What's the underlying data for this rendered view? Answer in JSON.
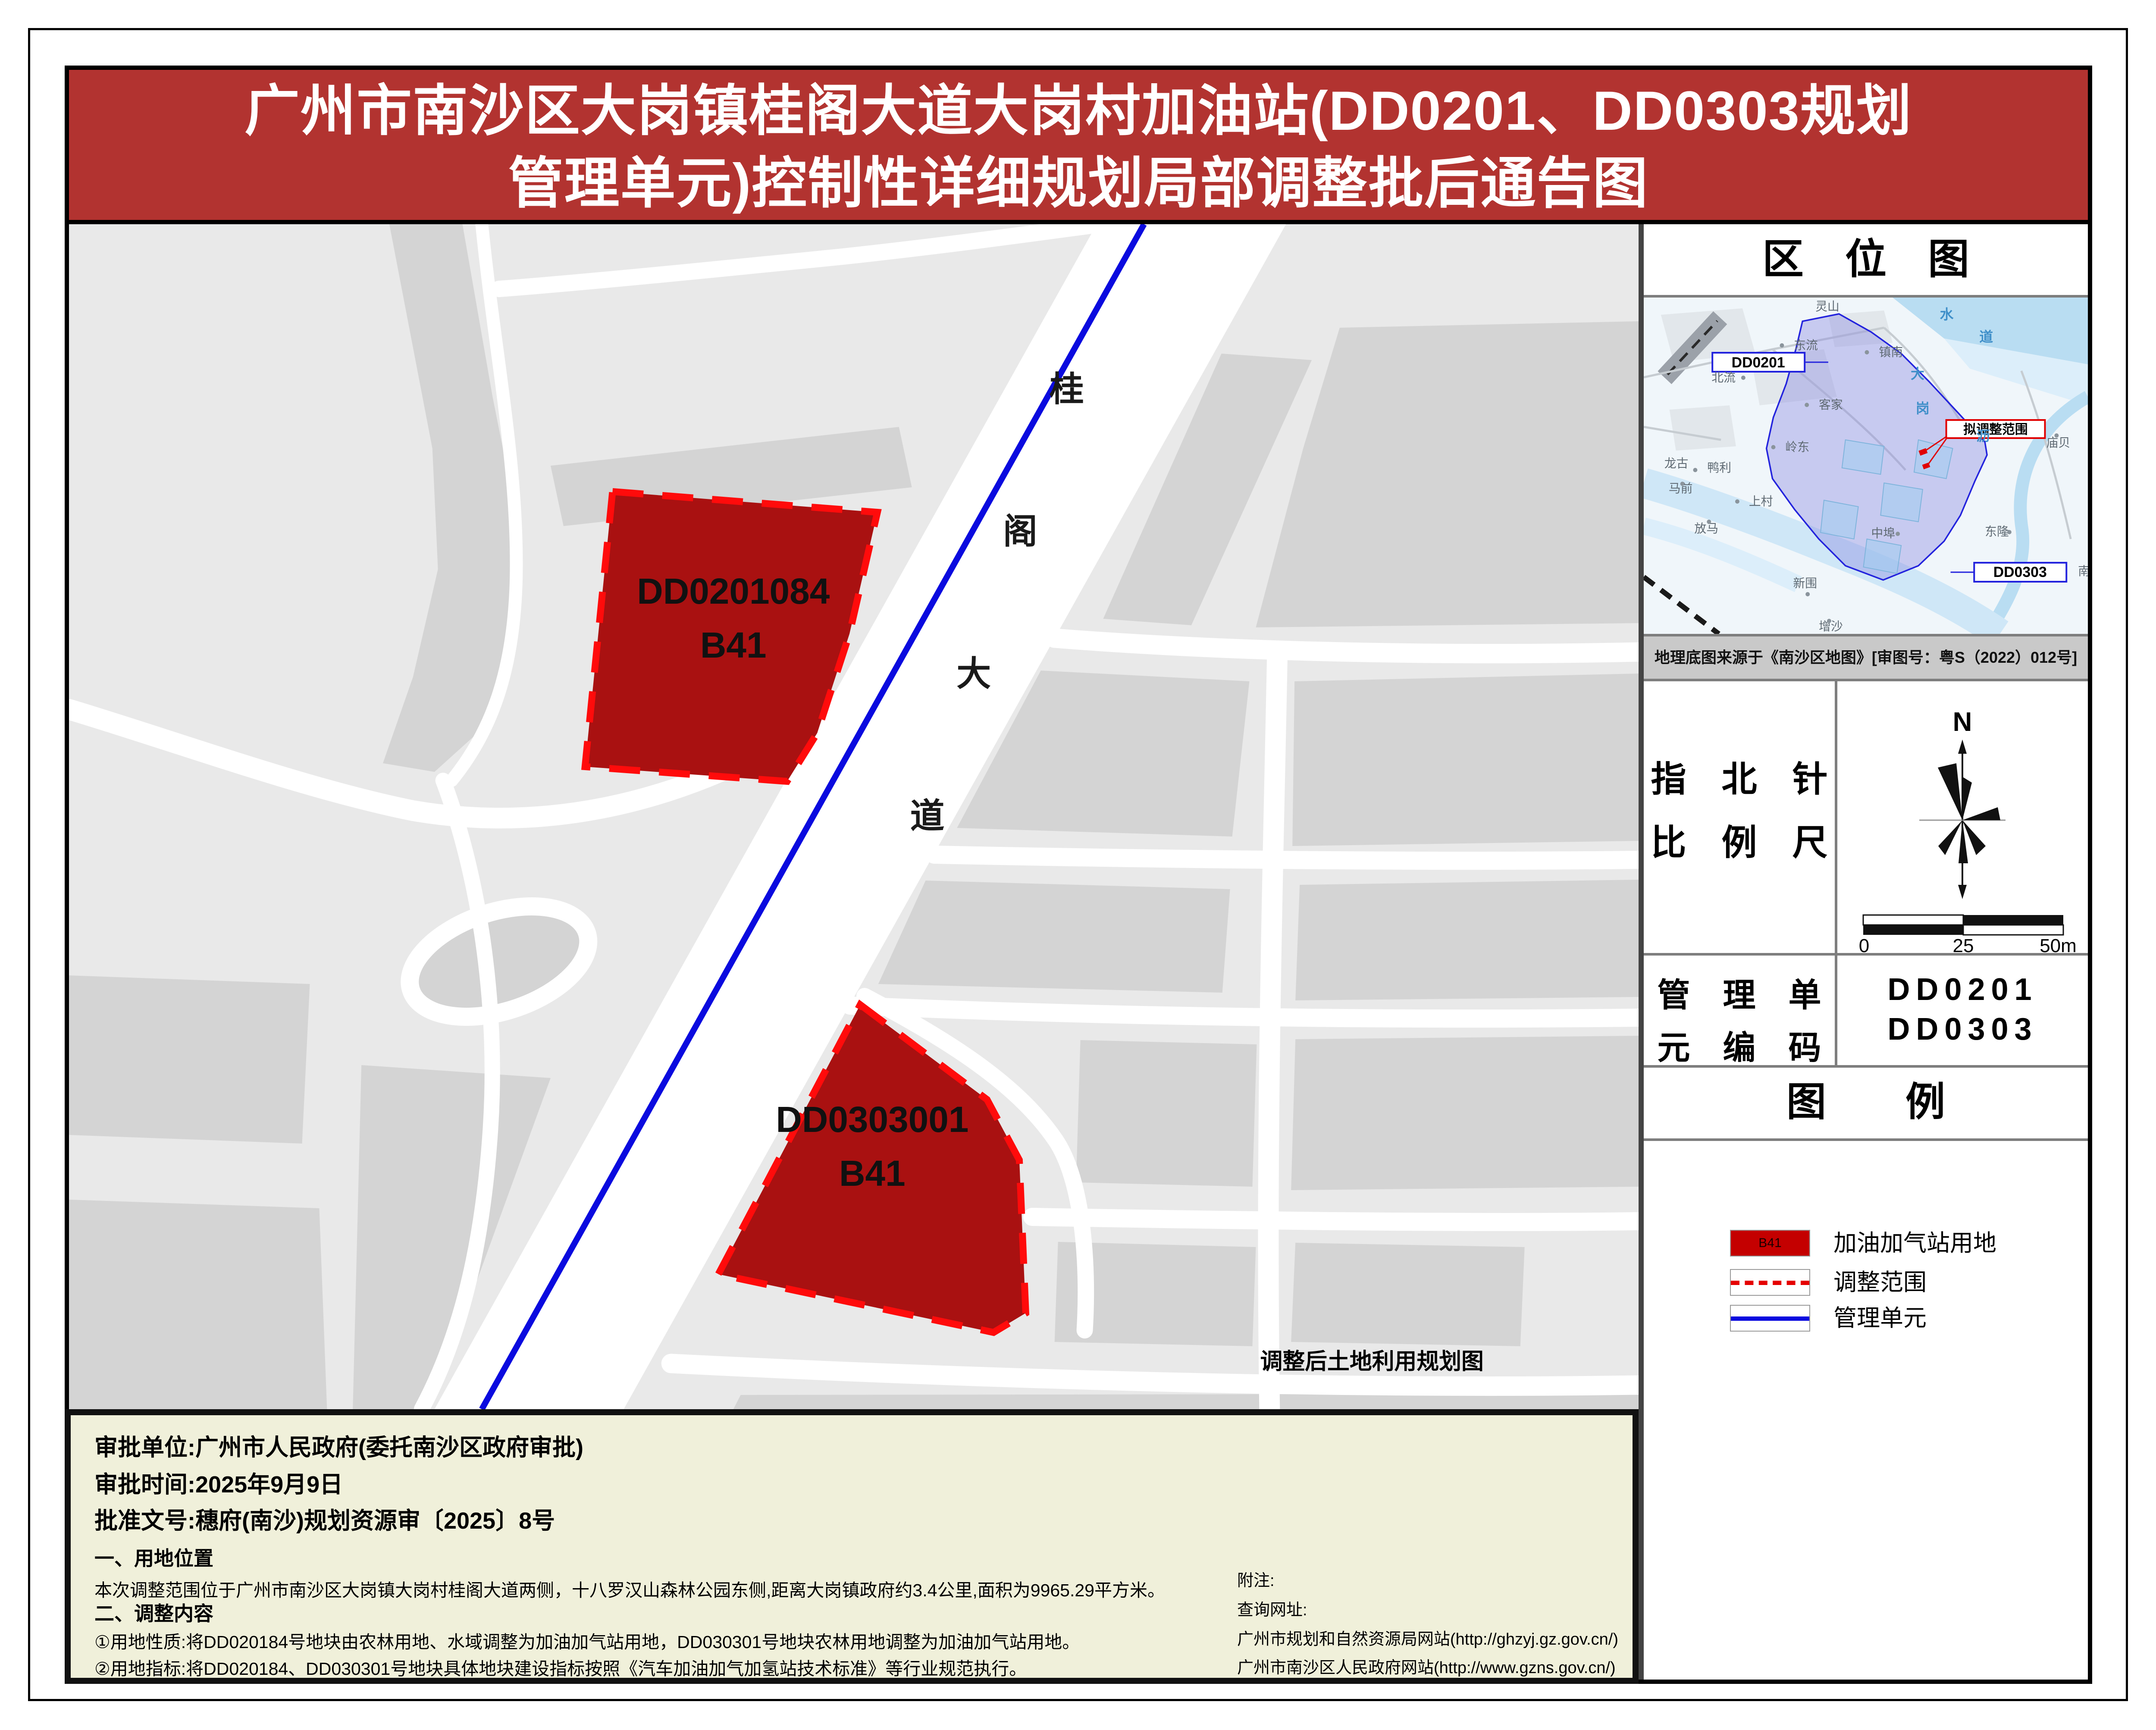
{
  "colors": {
    "title_red": "#b23330",
    "parcel_fill": "#a91111",
    "parcel_dash": "#ff0b0b",
    "legend_red": "#c40000",
    "unit_blue": "#0a0adf",
    "footer_yellow": "#f0f0da"
  },
  "title": {
    "line1": "广州市南沙区大岗镇桂阁大道大岗村加油站(DD0201、DD0303规划",
    "line2": "管理单元)控制性详细规划局部调整批后通告图"
  },
  "map": {
    "parcels": [
      {
        "code": "DD0201084",
        "use": "B41"
      },
      {
        "code": "DD0303001",
        "use": "B41"
      }
    ],
    "road_name": [
      "桂",
      "阁",
      "大",
      "道"
    ],
    "caption": "调整后土地利用规划图"
  },
  "sidebar": {
    "loc_title": "区　位　图",
    "locmap": {
      "boxes": {
        "dd0201": "DD0201",
        "dd0303": "DD0303",
        "adjust": "拟调整范围"
      },
      "places": [
        "灵山",
        "东流",
        "镇南",
        "北流",
        "客家",
        "岭东",
        "龙古",
        "鸭利",
        "马前",
        "上村",
        "放马",
        "中埠",
        "东隆",
        "新围",
        "增沙",
        "庙贝",
        "南"
      ],
      "water": [
        "水",
        "道",
        "大",
        "岗",
        "沥"
      ]
    },
    "source_note": "地理底图来源于《南沙区地图》[审图号：粤S（2022）012号]",
    "compass": {
      "label_line1": "指　北　针",
      "label_line2": "比　例　尺",
      "north": "N",
      "scale_ticks": [
        "0",
        "25",
        "50m"
      ]
    },
    "unit": {
      "label_line1": "管　理　单",
      "label_line2": "元　编　码",
      "codes": [
        "DD0201",
        "DD0303"
      ]
    },
    "legend": {
      "title": "图　　例",
      "items": [
        {
          "swatch_label": "B41",
          "label": "加油加气站用地"
        },
        {
          "label": "调整范围"
        },
        {
          "label": "管理单元"
        }
      ]
    }
  },
  "footer": {
    "approval_unit": "审批单位:广州市人民政府(委托南沙区政府审批)",
    "approval_date": "审批时间:2025年9月9日",
    "approval_doc": "批准文号:穗府(南沙)规划资源审〔2025〕8号",
    "sec1_title": "一、用地位置",
    "sec1_body": "本次调整范围位于广州市南沙区大岗镇大岗村桂阁大道两侧，十八罗汉山森林公园东侧,距离大岗镇政府约3.4公里,面积为9965.29平方米。",
    "sec2_title": "二、调整内容",
    "sec2_item1": "①用地性质:将DD020184号地块由农林用地、水域调整为加油加气站用地，DD030301号地块农林用地调整为加油加气站用地。",
    "sec2_item2": "②用地指标:将DD020184、DD030301号地块具体地块建设指标按照《汽车加油加气加氢站技术标准》等行业规范执行。",
    "notes_title": "附注:",
    "notes_sub": "查询网址:",
    "notes_url1": "广州市规划和自然资源局网站(http://ghzyj.gz.gov.cn/)",
    "notes_url2": "广州市南沙区人民政府网站(http://www.gzns.gov.cn/)"
  }
}
